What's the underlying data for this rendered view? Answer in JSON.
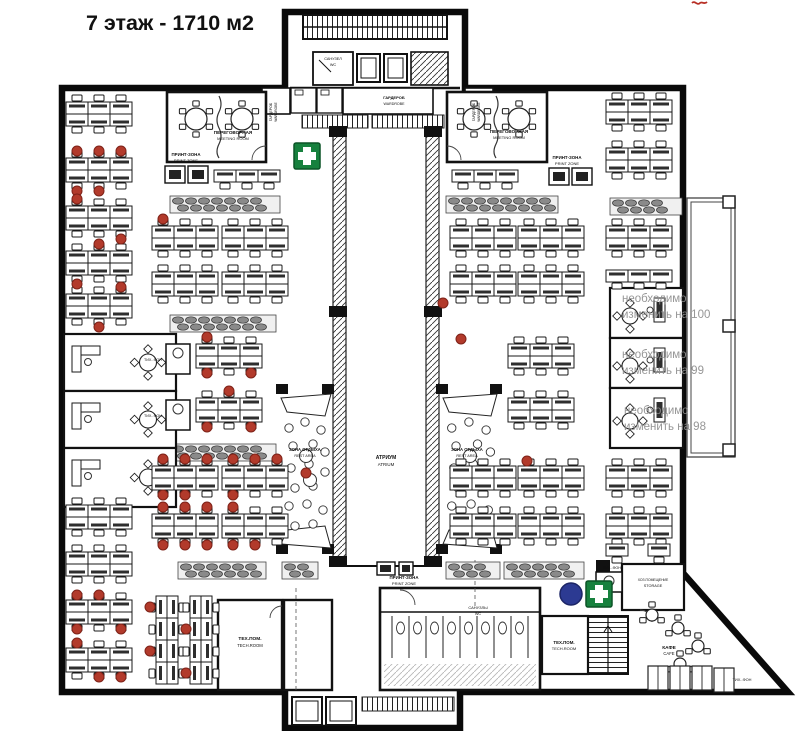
{
  "title": "7 этаж - 1710 м2",
  "colors": {
    "wall": "#0d0d0d",
    "first_aid_green": "#17813e",
    "marker_blue": "#2c3a92",
    "chair_red": "#b23a2b",
    "annotation_gray": "#8e8e8e"
  },
  "plan": {
    "labels": [
      [
        "ПЕРЕГОВОРНАЯ",
        233,
        134,
        4.6,
        "b"
      ],
      [
        "MEETING ROOM",
        233,
        140,
        4,
        ""
      ],
      [
        "ПЕРЕГОВОРНАЯ",
        509,
        133,
        4.6,
        "b"
      ],
      [
        "MEETING ROOM",
        509,
        139,
        4,
        ""
      ],
      [
        "ПРИНТ-ЗОНА",
        186,
        156,
        4.4,
        "b"
      ],
      [
        "PRINT ZONE",
        186,
        162,
        4,
        ""
      ],
      [
        "ПРИНТ-ЗОНА",
        567,
        159,
        4.4,
        "b"
      ],
      [
        "PRINT ZONE",
        567,
        165,
        4,
        ""
      ],
      [
        "ПРИНТ-ЗОНА",
        404,
        579,
        4.4,
        "b"
      ],
      [
        "PRINT ZONE",
        404,
        585,
        4,
        ""
      ],
      [
        "ГАРДЕРОБ",
        272,
        112,
        3.6,
        "r"
      ],
      [
        "WARDROBE",
        277,
        112,
        3.3,
        "r"
      ],
      [
        "ГАРДЕРОБ",
        394,
        99,
        4,
        "b"
      ],
      [
        "WARDROBE",
        394,
        105,
        3.6,
        ""
      ],
      [
        "ГАРДЕРОБ",
        475,
        112,
        3.6,
        "r"
      ],
      [
        "WARDROBE",
        480,
        112,
        3.3,
        "r"
      ],
      [
        "САНУЗЕЛ",
        333,
        60,
        3.8,
        ""
      ],
      [
        "WC",
        333,
        66,
        3.8,
        ""
      ],
      [
        "АТРИУМ",
        386,
        459,
        5,
        "b"
      ],
      [
        "ATRIUM",
        386,
        466,
        4.4,
        ""
      ],
      [
        "ЗОНА ОТДЫХА",
        305,
        451,
        4.2,
        "b"
      ],
      [
        "REST AREA",
        305,
        457,
        3.8,
        ""
      ],
      [
        "ЗОНА ОТДЫХА",
        467,
        451,
        4.2,
        "b"
      ],
      [
        "REST AREA",
        467,
        457,
        3.8,
        ""
      ],
      [
        "ТЕХ.ПОМ.",
        250,
        640,
        4.8,
        "b"
      ],
      [
        "TECH.ROOM",
        250,
        647,
        4.2,
        ""
      ],
      [
        "ТЕХ.ПОМ.",
        564,
        644,
        4.4,
        "b"
      ],
      [
        "TECH.ROOM",
        564,
        650,
        4,
        ""
      ],
      [
        "САНУЗЛЫ",
        478,
        609,
        4,
        ""
      ],
      [
        "WC",
        478,
        615,
        3.8,
        ""
      ],
      [
        "ХОЗ.ПОМЕЩЕНИЕ",
        653,
        581,
        3.4,
        ""
      ],
      [
        "STORAGE",
        653,
        587,
        3.8,
        ""
      ],
      [
        "КАФЕ",
        669,
        649,
        4.8,
        "b"
      ],
      [
        "CAFE",
        669,
        655,
        4.2,
        ""
      ],
      [
        "ТИХ.-ФОН",
        153,
        361,
        3.7,
        ""
      ],
      [
        "ТИХ.-ФОН",
        153,
        417,
        3.7,
        ""
      ],
      [
        "ТИХ.-ФОН",
        612,
        569,
        3.7,
        ""
      ],
      [
        "ТИХ.-ФОН",
        742,
        681,
        3.9,
        ""
      ]
    ],
    "annotations": [
      [
        "необходимо",
        622,
        302
      ],
      [
        "изменить на 100",
        622,
        318
      ],
      [
        "необходимо",
        622,
        358
      ],
      [
        "изменить на 99",
        622,
        374
      ],
      [
        "необходимо",
        624,
        414
      ],
      [
        "изменить на 98",
        624,
        430
      ]
    ],
    "clusters_h": [
      [
        66,
        102
      ],
      [
        66,
        158
      ],
      [
        66,
        206
      ],
      [
        66,
        251
      ],
      [
        66,
        294
      ],
      [
        66,
        505
      ],
      [
        66,
        552
      ],
      [
        66,
        600
      ],
      [
        66,
        648
      ],
      [
        214,
        170,
        3,
        1
      ],
      [
        452,
        170,
        3,
        1
      ],
      [
        152,
        226
      ],
      [
        222,
        226
      ],
      [
        152,
        272
      ],
      [
        222,
        272
      ],
      [
        196,
        344
      ],
      [
        196,
        398
      ],
      [
        152,
        466
      ],
      [
        222,
        466
      ],
      [
        152,
        514
      ],
      [
        222,
        514
      ],
      [
        450,
        226
      ],
      [
        518,
        226
      ],
      [
        450,
        272
      ],
      [
        518,
        272
      ],
      [
        508,
        344
      ],
      [
        508,
        398
      ],
      [
        450,
        466
      ],
      [
        518,
        466
      ],
      [
        450,
        514
      ],
      [
        518,
        514
      ],
      [
        606,
        100
      ],
      [
        606,
        148
      ],
      [
        606,
        226
      ],
      [
        606,
        270,
        3,
        1
      ],
      [
        606,
        466
      ],
      [
        606,
        514
      ],
      [
        606,
        544,
        1,
        1
      ],
      [
        648,
        544,
        1,
        1
      ]
    ],
    "clusters_v": [
      [
        156,
        596,
        4
      ],
      [
        190,
        596,
        4
      ]
    ],
    "red_chairs": [
      [
        77,
        151
      ],
      [
        99,
        151
      ],
      [
        121,
        151
      ],
      [
        77,
        191
      ],
      [
        99,
        191
      ],
      [
        77,
        199
      ],
      [
        121,
        239
      ],
      [
        99,
        244
      ],
      [
        77,
        284
      ],
      [
        121,
        287
      ],
      [
        99,
        327
      ],
      [
        163,
        219
      ],
      [
        207,
        337
      ],
      [
        251,
        373
      ],
      [
        207,
        373
      ],
      [
        229,
        391
      ],
      [
        207,
        427
      ],
      [
        251,
        427
      ],
      [
        163,
        459
      ],
      [
        185,
        459
      ],
      [
        207,
        459
      ],
      [
        233,
        459
      ],
      [
        255,
        459
      ],
      [
        277,
        459
      ],
      [
        163,
        495
      ],
      [
        185,
        495
      ],
      [
        233,
        495
      ],
      [
        163,
        507
      ],
      [
        185,
        507
      ],
      [
        207,
        507
      ],
      [
        233,
        507
      ],
      [
        163,
        545
      ],
      [
        185,
        545
      ],
      [
        207,
        545
      ],
      [
        233,
        545
      ],
      [
        255,
        545
      ],
      [
        77,
        595
      ],
      [
        99,
        595
      ],
      [
        77,
        629
      ],
      [
        121,
        629
      ],
      [
        77,
        643
      ],
      [
        99,
        677
      ],
      [
        121,
        677
      ],
      [
        150,
        607
      ],
      [
        186,
        629
      ],
      [
        150,
        651
      ],
      [
        186,
        673
      ],
      [
        443,
        303
      ],
      [
        306,
        473
      ],
      [
        461,
        339
      ],
      [
        527,
        461
      ]
    ],
    "lounges": [
      [
        170,
        196,
        110
      ],
      [
        446,
        196,
        112
      ],
      [
        610,
        198,
        72
      ],
      [
        170,
        315,
        106
      ],
      [
        170,
        444,
        106
      ],
      [
        178,
        562,
        88
      ],
      [
        282,
        562,
        36
      ],
      [
        446,
        562,
        54
      ],
      [
        504,
        562,
        80
      ]
    ],
    "tables": [
      [
        196,
        119,
        11,
        6
      ],
      [
        242,
        119,
        11,
        6
      ],
      [
        474,
        119,
        11,
        6
      ],
      [
        519,
        119,
        11,
        6
      ],
      [
        652,
        615,
        6,
        3
      ],
      [
        678,
        628,
        6,
        3
      ],
      [
        698,
        646,
        6,
        3
      ],
      [
        680,
        664,
        6,
        3
      ]
    ],
    "rest_areas": [
      {
        "x": 279,
        "y": 392,
        "w": 54,
        "h": 158
      },
      {
        "x": 441,
        "y": 392,
        "w": 58,
        "h": 158
      }
    ],
    "offices_left": [
      {
        "x": 64,
        "y": 334,
        "w": 112,
        "h": 57
      },
      {
        "x": 64,
        "y": 391,
        "w": 112,
        "h": 57
      },
      {
        "x": 64,
        "y": 448,
        "w": 112,
        "h": 59
      }
    ],
    "offices_right": [
      {
        "x": 610,
        "y": 288,
        "w": 73,
        "h": 50
      },
      {
        "x": 610,
        "y": 338,
        "w": 73,
        "h": 50
      },
      {
        "x": 610,
        "y": 388,
        "w": 73,
        "h": 60
      }
    ],
    "phone_booths": [
      {
        "x": 166,
        "y": 344,
        "w": 24,
        "h": 30
      },
      {
        "x": 166,
        "y": 400,
        "w": 24,
        "h": 30
      },
      {
        "x": 596,
        "y": 572,
        "w": 26,
        "h": 20
      }
    ],
    "cafe_booths": [
      [
        648,
        666
      ],
      [
        670,
        666
      ],
      [
        692,
        666
      ],
      [
        714,
        668
      ]
    ],
    "markers": {
      "green_crosses": [
        [
          294,
          143
        ],
        [
          586,
          581
        ]
      ],
      "blue_circle": {
        "x": 571,
        "y": 594,
        "r": 11
      }
    }
  }
}
